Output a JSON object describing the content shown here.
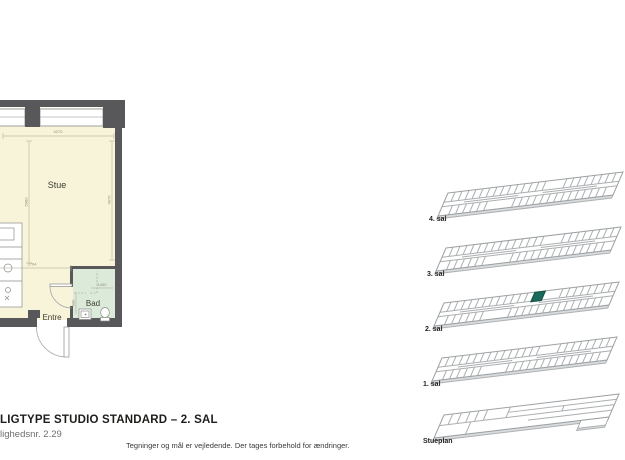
{
  "title_block": {
    "title": "LIGTYPE STUDIO STANDARD – 2. SAL",
    "apartment_no": "lighedsnr. 2.29",
    "disclaimer": "Tegninger og mål er vejledende. Der tages forbehold for ændringer."
  },
  "floor_plan": {
    "rooms": [
      {
        "name": "Stue"
      },
      {
        "name": "Bad"
      },
      {
        "name": "Entre"
      }
    ],
    "dimensions": {
      "stue_width": "4270",
      "stue_height_left": "5980",
      "stue_height_right": "4970",
      "kitchen_width": "2704",
      "bad_width": "1400",
      "bad_depth": "900"
    },
    "colors": {
      "floor": "#f8f4da",
      "bathroom": "#dcead9",
      "walls": "#58585a"
    }
  },
  "stack_diagram": {
    "floors": [
      {
        "label": "4. sal",
        "highlighted": false
      },
      {
        "label": "3. sal",
        "highlighted": false
      },
      {
        "label": "2. sal",
        "highlighted": true
      },
      {
        "label": "1. sal",
        "highlighted": false
      },
      {
        "label": "Stueplan",
        "highlighted": false
      }
    ],
    "highlight_color": "#1b6b5c"
  }
}
